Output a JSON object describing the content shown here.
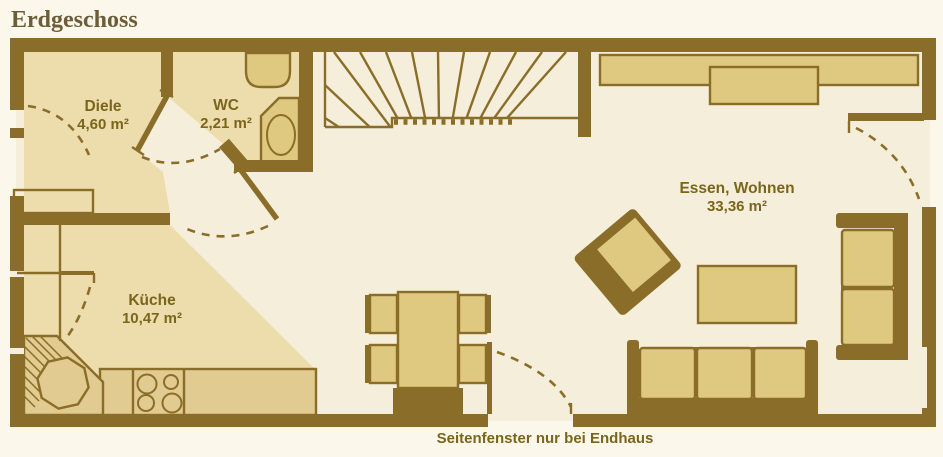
{
  "title": "Erdgeschoss",
  "caption": "Seitenfenster nur bei Endhaus",
  "rooms": [
    {
      "name": "Diele",
      "area": "4,60 m²"
    },
    {
      "name": "WC",
      "area": "2,21 m²"
    },
    {
      "name": "Küche",
      "area": "10,47 m²"
    },
    {
      "name": "Essen, Wohnen",
      "area": "33,36 m²"
    }
  ],
  "colors": {
    "bg": "#FBF8EB",
    "wall": "#8A6D28",
    "floor-light": "#F5EEDA",
    "floor-tan": "#EDDDAC",
    "furniture": "#DFC981",
    "counter": "#E1CB90",
    "label": "#7A661B",
    "title": "#6C5C38"
  }
}
